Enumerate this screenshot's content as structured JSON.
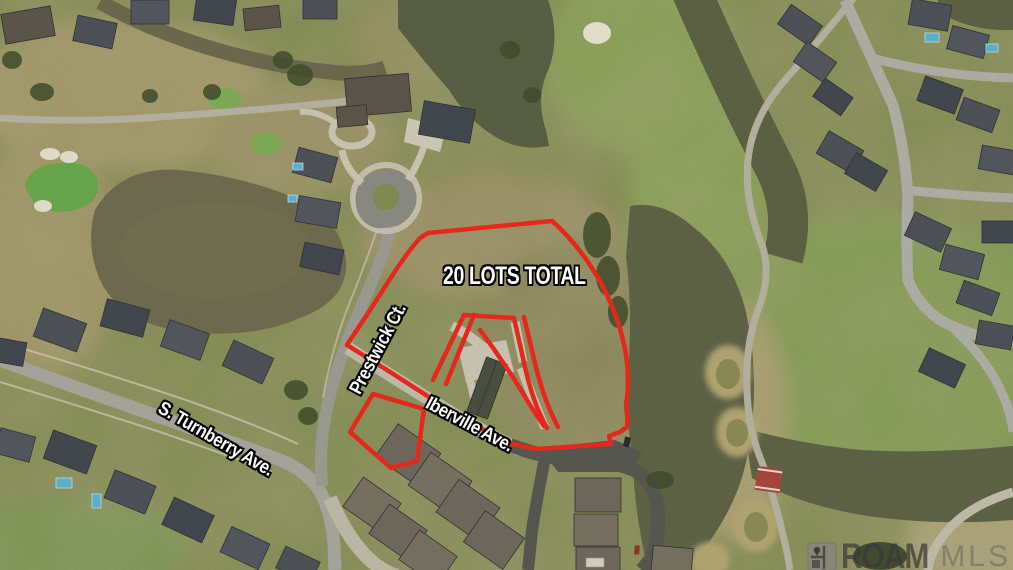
{
  "annotations": {
    "lots_label": "20 LOTS TOTAL",
    "street_labels": {
      "prestwick": "Prestwick Ct.",
      "iberville": "Iberville Ave.",
      "turnberry": "S. Turnberry Ave."
    }
  },
  "watermark": {
    "brand": "ROAM",
    "suffix": "MLS",
    "icon": "map-pin-logo-icon"
  },
  "colors": {
    "boundary_red": "#e5281c",
    "label_fill": "#ffffff",
    "label_outline": "#000000",
    "watermark_text": "#3a3a3a"
  }
}
